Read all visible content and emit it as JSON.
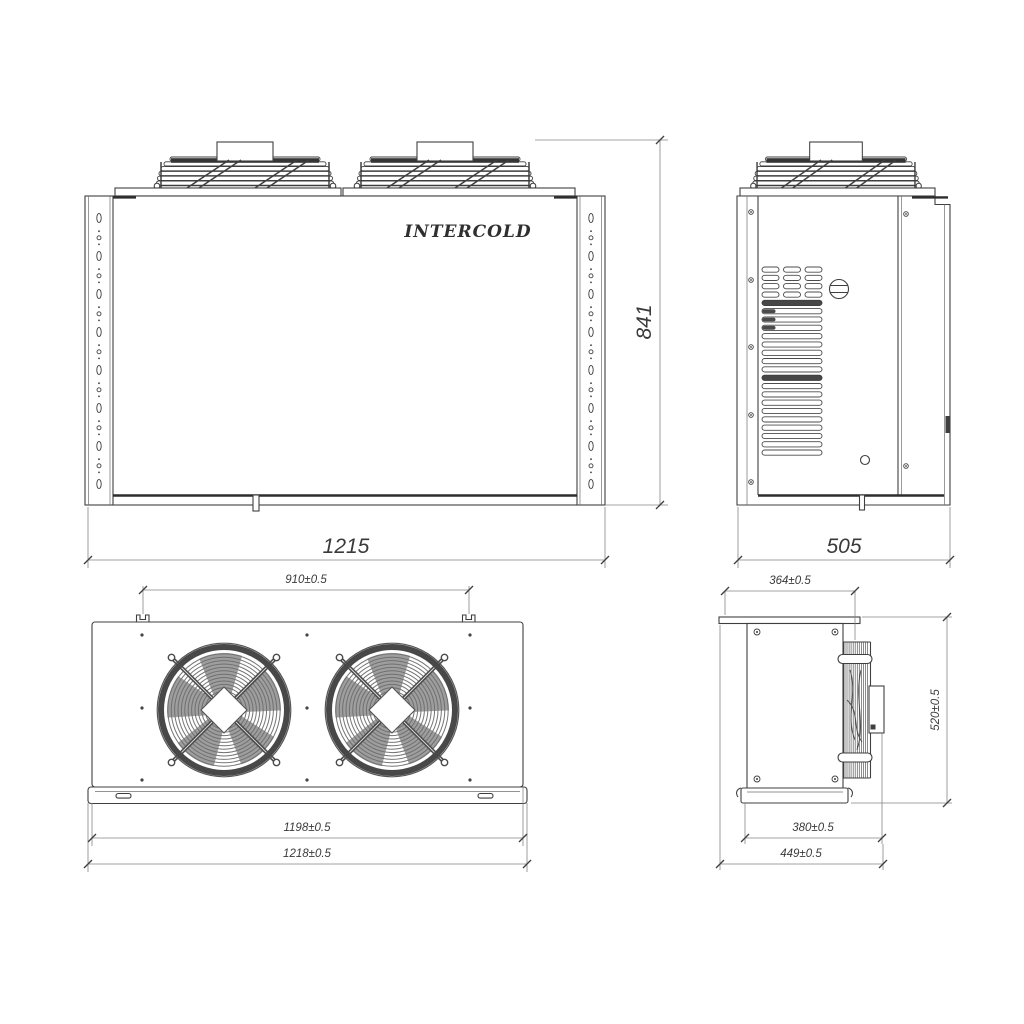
{
  "drawing": {
    "brand": "INTERCOLD",
    "background": "#ffffff",
    "line_color": "#3f3f3f",
    "views": {
      "front": {
        "label": "front-view",
        "width_mm": "1215",
        "height_mm": "841"
      },
      "side": {
        "label": "side-view",
        "depth_mm": "505"
      },
      "plan": {
        "label": "plan-view",
        "mount_spacing_mm": "910±0.5",
        "body_width_mm": "1198±0.5",
        "overall_width_mm": "1218±0.5"
      },
      "side_plan": {
        "label": "side-plan-view",
        "mount_depth_mm": "364±0.5",
        "height_mm": "520±0.5",
        "body_depth_mm": "380±0.5",
        "overall_depth_mm": "449±0.5"
      }
    }
  }
}
